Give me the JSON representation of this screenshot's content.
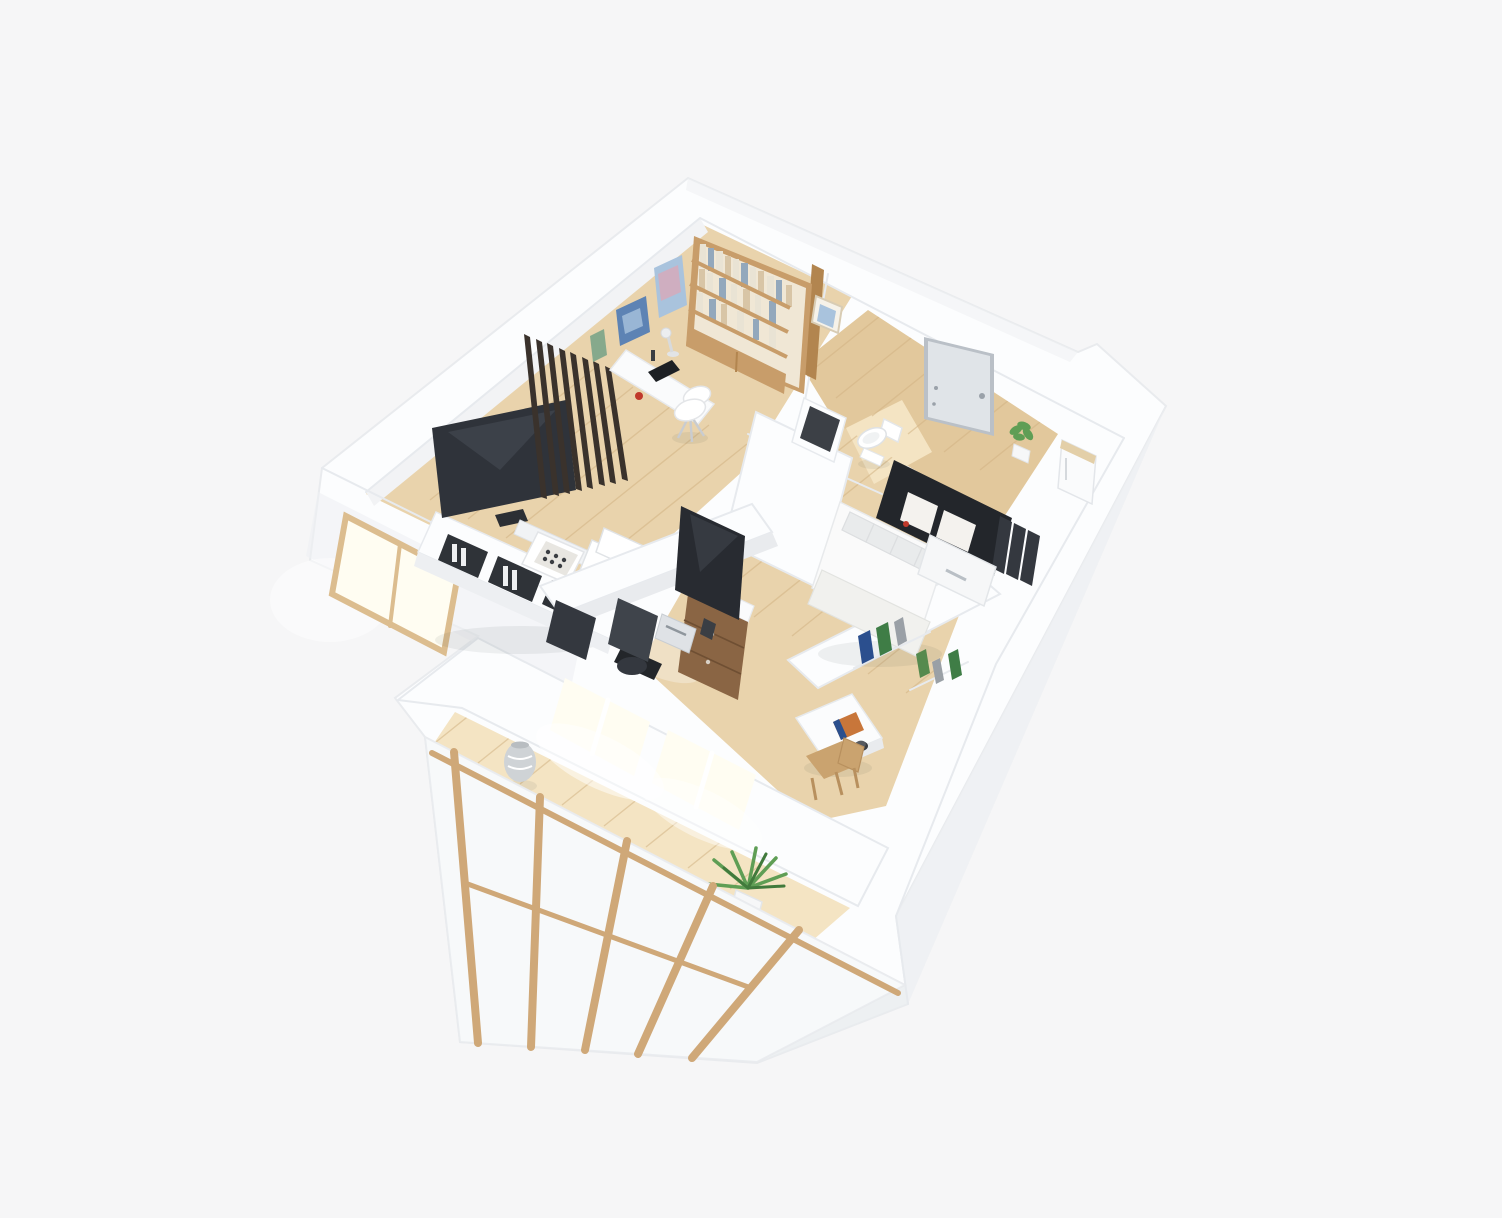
{
  "scene": {
    "kind": "isometric-3d-floor-plan-render",
    "style": "photoreal white scandinavian apartment model on light gray backdrop",
    "rooms": [
      {
        "name": "living-room",
        "furniture": [
          "tv",
          "media-console",
          "soundbar",
          "coffee-table",
          "lounge-chair",
          "slat-divider"
        ]
      },
      {
        "name": "study",
        "furniture": [
          "bookshelf",
          "desk",
          "desk-lamp",
          "laptop",
          "white-chair",
          "wall-art"
        ]
      },
      {
        "name": "entry-hall",
        "furniture": [
          "front-door",
          "potted-plant",
          "refrigerator",
          "wall-frame"
        ]
      },
      {
        "name": "bathroom",
        "furniture": [
          "toilet",
          "dark-panel"
        ]
      },
      {
        "name": "bedroom",
        "furniture": [
          "bed",
          "pillows",
          "dark-headboard-panel",
          "magazines",
          "book-shelf"
        ]
      },
      {
        "name": "workspace",
        "furniture": [
          "monitor",
          "keyboard",
          "printer",
          "wood-cabinet",
          "office-chairs",
          "low-partition"
        ]
      },
      {
        "name": "balcony-sunroom",
        "furniture": [
          "bright-windows",
          "vase",
          "palm-plant",
          "wood-framed-sliding-panels"
        ]
      }
    ]
  },
  "colors": {
    "bg": "#f6f6f7",
    "building_white": "#fcfdfe",
    "crease": "#e7eaee",
    "face_shade": "#eef0f3",
    "face_shade2": "#e9ecef",
    "wall_inner": "#f2f3f5",
    "floor_wood": "#e9d3ac",
    "floor_wood_deep": "#e2c89c",
    "floor_bright": "#f4e4c3",
    "plank_line": "#d2b384",
    "glow": "#fffdf2",
    "window_frame": "#dcbd8f",
    "slat_dark": "#3a322c",
    "tv_screen": "#2f333a",
    "tv_reflect": "#474d56",
    "soundbar": "#f1f3f5",
    "console_front": "#edeff2",
    "inset_dark": "#2f3338",
    "art_blue": "#5d83b4",
    "art_blue_light": "#a9c3dd",
    "art_green": "#86a98c",
    "art_pink": "#cfaec0",
    "shelf_wood": "#c89d6a",
    "shelf_wood_side": "#b2854f",
    "shelf_interior": "#f0e7d5",
    "book_light": "#e9e3d4",
    "book_bluegray": "#93a8bc",
    "book_tan": "#d8c5a6",
    "desk_white": "#fafbfc",
    "laptop_dark": "#1d2024",
    "red_accent": "#c0392b",
    "chair_white": "#ffffff",
    "door_panel": "#e0e4e8",
    "door_frame": "#bac0c7",
    "hardware": "#9aa1a9",
    "plant_green": "#5f9e55",
    "plant_green_dark": "#417a3c",
    "pot_white": "#f6f7f8",
    "appliance_white": "#fafbfc",
    "appliance_top": "#e3cfa8",
    "toilet_white": "#ffffff",
    "panel_dark": "#3c4046",
    "partition_face": "#e9ebee",
    "monitor_dark": "#282b31",
    "keyboard_dark": "#23262a",
    "printer_gray": "#dfe2e6",
    "cabinet_wood": "#8a6544",
    "chair_dark": "#3f444b",
    "chair_dark2": "#34383f",
    "bed_white": "#fafafa",
    "pillow_gray": "#e9ebec",
    "blanket": "#f1f1ee",
    "headboard_dark": "#23262b",
    "page_white": "#f4f2ee",
    "book_blue": "#2b4f8e",
    "book_green": "#3f7d46",
    "book_gray": "#9aa0a6",
    "book_green2": "#568a4e",
    "table_white": "#fbfcfd",
    "book_orange": "#c8763a",
    "cup_dark": "#3a3d42",
    "chair_wood": "#caa36f",
    "vase_gray": "#cfd3d6",
    "stile_wood": "#cfa878",
    "shadow_gray": "#2f3338"
  }
}
